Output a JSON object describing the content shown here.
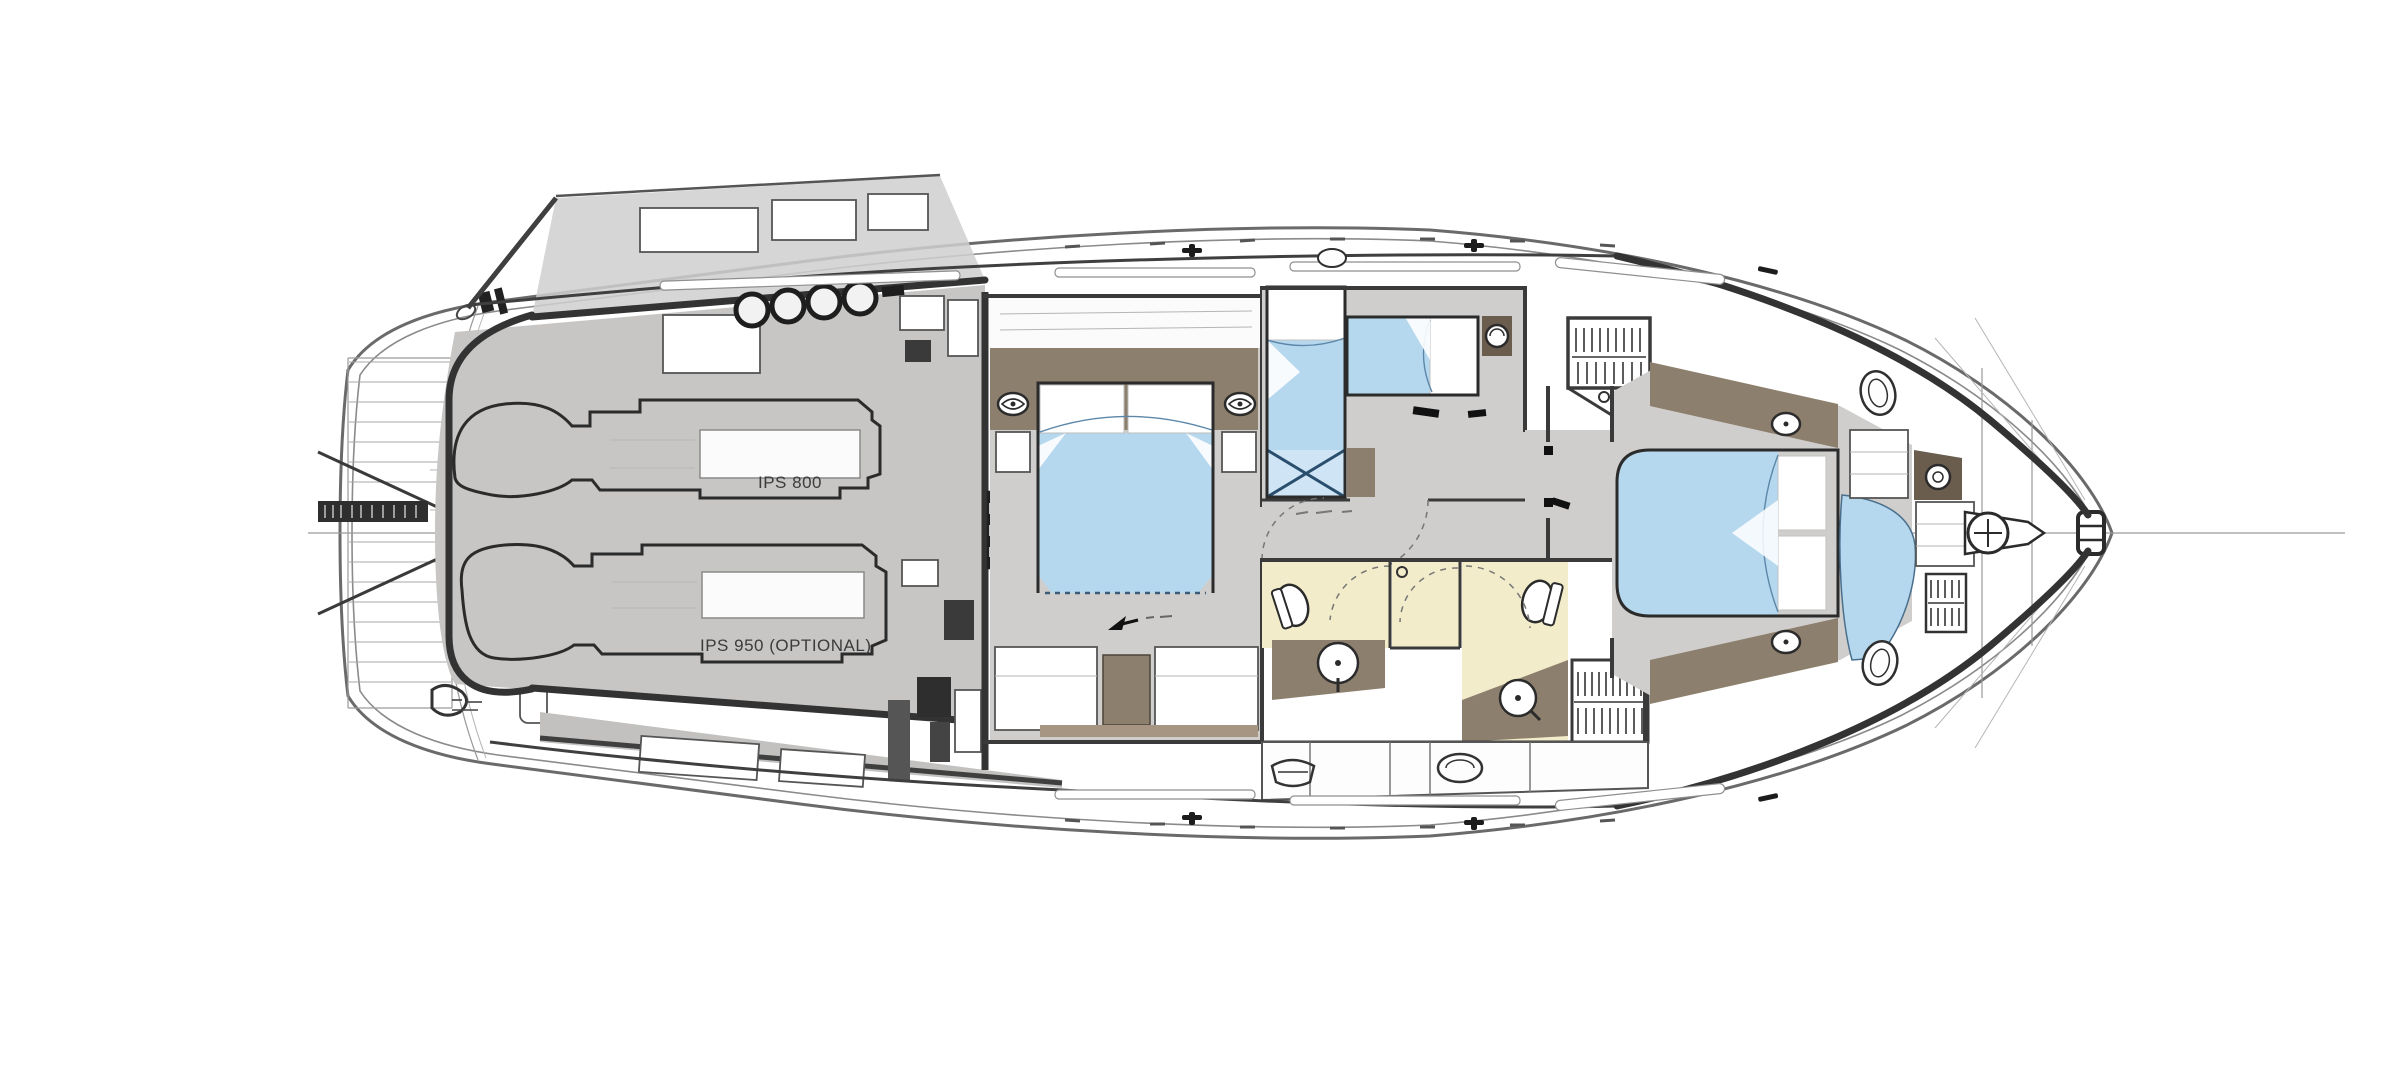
{
  "type": "yacht-lower-deck-floor-plan",
  "orientation": {
    "bow": "right",
    "stern": "left"
  },
  "labels": {
    "engine_1": "IPS 800",
    "engine_2": "IPS 950 (OPTIONAL)"
  },
  "colors": {
    "background": "#ffffff",
    "floor_gray": "#cfcecc",
    "engine_room_gray": "#c9c8c6",
    "bed_blue": "#b5d8ee",
    "wood_brown": "#8d7f6d",
    "wood_dark": "#6b5d4e",
    "bath_floor_yellow": "#f2ecca",
    "outline_dark": "#3a3a3a",
    "hull_line_gray": "#6a6a6a"
  },
  "icons": [
    "reading-light-icon",
    "porthole-icon",
    "deck-hatch-icon",
    "windlass-icon",
    "cleat-icon",
    "hanging-clothes-icon",
    "sink-icon",
    "toilet-icon",
    "washer-icon",
    "shower-icon",
    "arrow-icon",
    "rings-icon",
    "transom-plate"
  ],
  "rooms_depicted_count": 7
}
